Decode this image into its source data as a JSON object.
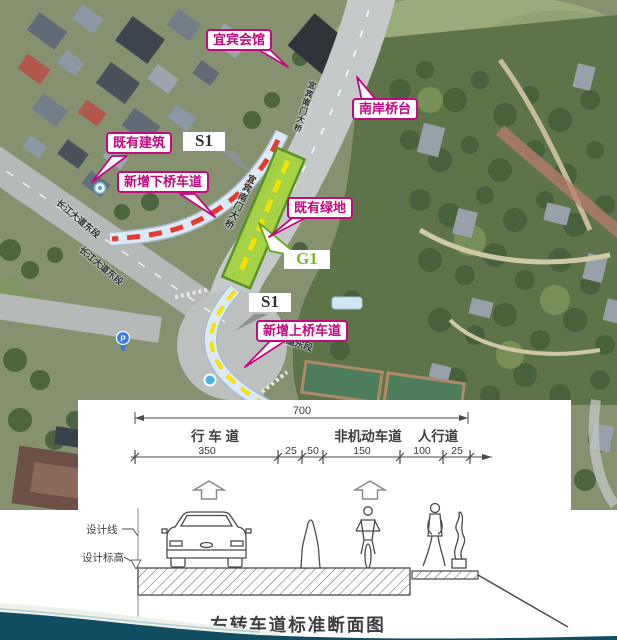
{
  "map": {
    "callouts": {
      "yibin_hall": "宜宾会馆",
      "south_abutment": "南岸桥台",
      "existing_building": "既有建筑",
      "new_down_lane": "新增下桥车道",
      "existing_green": "既有绿地",
      "new_up_lane": "新增上桥车道"
    },
    "markers": {
      "s1_top": "S1",
      "g1": "G1",
      "s1_bottom": "S1"
    },
    "road_name": "长江大道东段",
    "bridge_name": "宜宾南门大桥",
    "poi": {
      "parking": "P"
    },
    "colors": {
      "callout_magenta": "#c4087f",
      "g1_green": "#76b82a",
      "red_dash": "#e8392e",
      "yellow_dash": "#f2e205",
      "green_strip": "#a4d341",
      "band_blue": "#d6e6f6"
    }
  },
  "cross_section": {
    "overall_width": "700",
    "lane_labels": [
      "行 车 道",
      "非机动车道",
      "人行道"
    ],
    "dims": [
      "350",
      "25",
      "50",
      "150",
      "100",
      "25"
    ],
    "design_line_label": "设计线",
    "design_elevation_label": "设计标高",
    "title": "右转车道标准断面图"
  }
}
